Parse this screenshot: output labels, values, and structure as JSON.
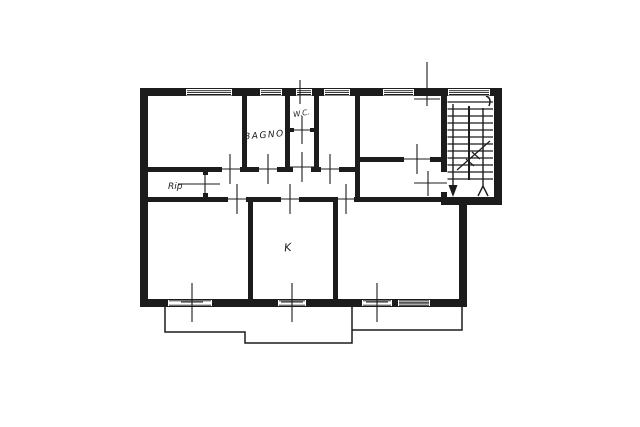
{
  "floorplan": {
    "room_labels": {
      "bathroom": "BAGNO",
      "wc": "W.C.",
      "storage": "Rip",
      "kitchen": "K"
    },
    "colors": {
      "ink": "#1c1c1c",
      "paper": "#ffffff"
    }
  }
}
